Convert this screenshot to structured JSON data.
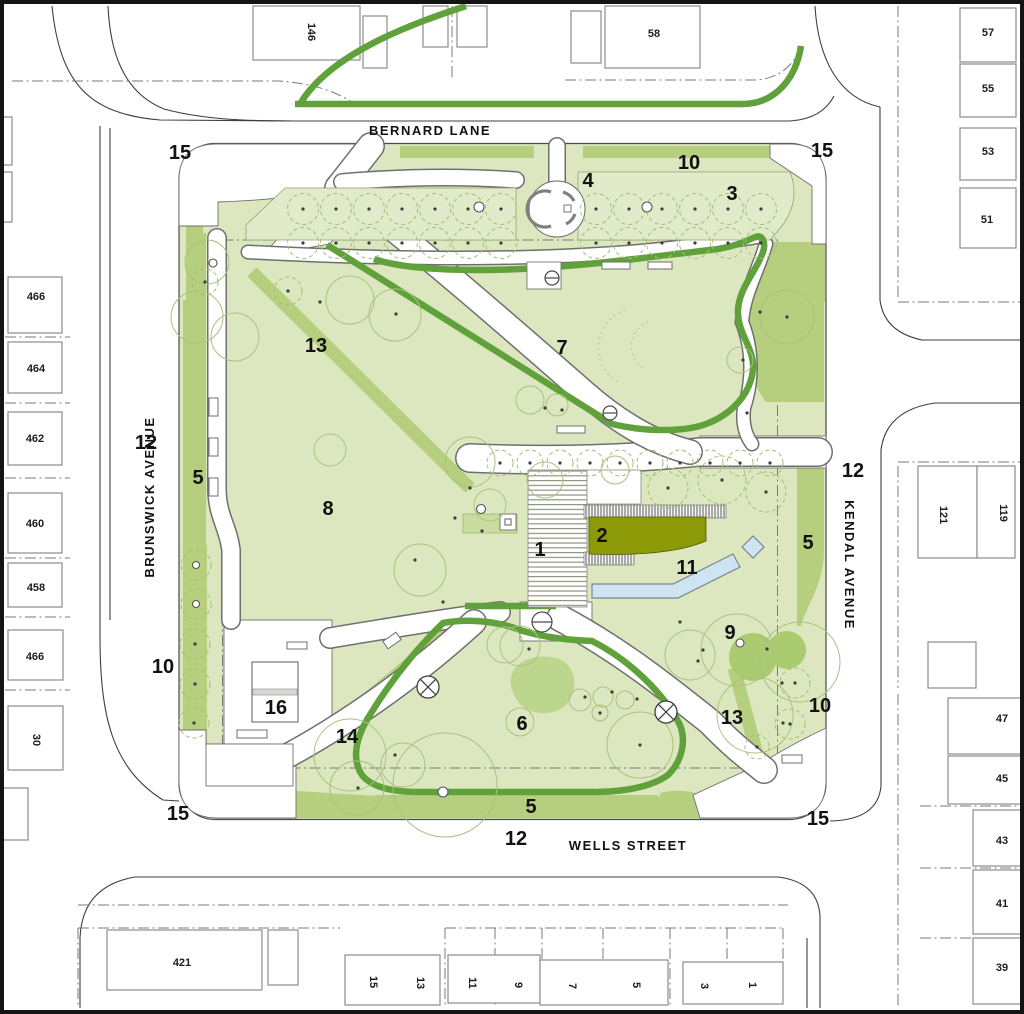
{
  "plan_title": "Neighbourhood park landscape site plan",
  "streets": {
    "top": "BERNARD LANE",
    "bottom": "WELLS STREET",
    "left": "BRUNSWICK AVENUE",
    "right": "KENDAL AVENUE"
  },
  "street_width_labels": [
    {
      "text": "12"
    },
    {
      "text": "12"
    },
    {
      "text": "12"
    }
  ],
  "area_labels": [
    {
      "text": "15"
    },
    {
      "text": "10"
    },
    {
      "text": "4"
    },
    {
      "text": "3"
    },
    {
      "text": "15"
    },
    {
      "text": "13"
    },
    {
      "text": "7"
    },
    {
      "text": "5"
    },
    {
      "text": "8"
    },
    {
      "text": "1"
    },
    {
      "text": "2"
    },
    {
      "text": "11"
    },
    {
      "text": "5"
    },
    {
      "text": "10"
    },
    {
      "text": "16"
    },
    {
      "text": "14"
    },
    {
      "text": "6"
    },
    {
      "text": "9"
    },
    {
      "text": "13"
    },
    {
      "text": "10"
    },
    {
      "text": "15"
    },
    {
      "text": "5"
    },
    {
      "text": "15"
    }
  ],
  "building_labels": [
    {
      "text": "146"
    },
    {
      "text": "58"
    },
    {
      "text": "57"
    },
    {
      "text": "55"
    },
    {
      "text": "53"
    },
    {
      "text": "51"
    },
    {
      "text": "466"
    },
    {
      "text": "464"
    },
    {
      "text": "462"
    },
    {
      "text": "460"
    },
    {
      "text": "458"
    },
    {
      "text": "466"
    },
    {
      "text": "30"
    },
    {
      "text": "121"
    },
    {
      "text": "119"
    },
    {
      "text": "47"
    },
    {
      "text": "45"
    },
    {
      "text": "43"
    },
    {
      "text": "41"
    },
    {
      "text": "39"
    },
    {
      "text": "421"
    },
    {
      "text": "15"
    },
    {
      "text": "13"
    },
    {
      "text": "11"
    },
    {
      "text": "9"
    },
    {
      "text": "7"
    },
    {
      "text": "5"
    },
    {
      "text": "3"
    },
    {
      "text": "1"
    }
  ],
  "legend_icons": [
    {
      "name": "deciduous-tree-icon"
    },
    {
      "name": "tree-canopy-icon"
    },
    {
      "name": "bench-icon"
    },
    {
      "name": "light-pole-icon"
    },
    {
      "name": "drinking-fountain-icon"
    }
  ],
  "colors": {
    "lawn": "#dce7bf",
    "panel": "#e1ebca",
    "medium_green": "#b5cf7e",
    "dark_green_accent": "#60a13c",
    "olive_building": "#8d9a07",
    "pool_blue": "#cfe4f2",
    "playground_green": "#bdd68d",
    "tree_outline": "#a6c07b",
    "street_line": "#3f3f3f",
    "frame": "#141414"
  }
}
